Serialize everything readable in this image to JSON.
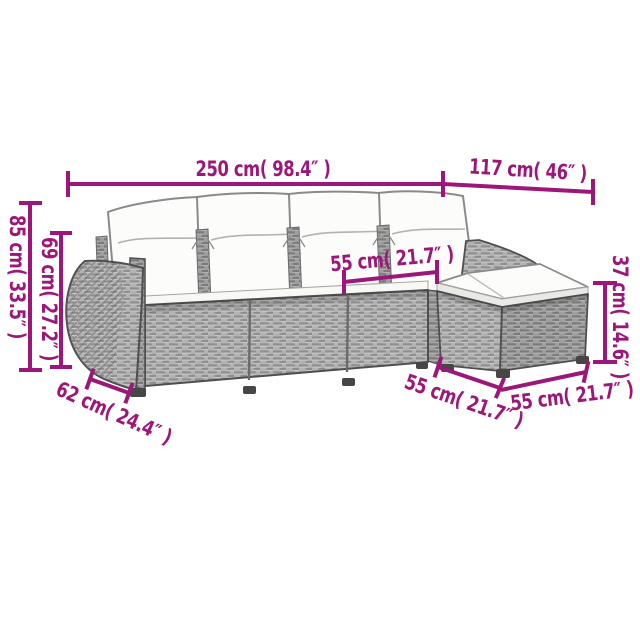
{
  "colors": {
    "accent": "#9c1779",
    "rattan": "#b3b3b3",
    "rattan_dark": "#9f9f9f",
    "weave_line": "#8f8f8f",
    "cushion": "#fcfcfa",
    "outline": "#4f4f4f",
    "background": "#ffffff"
  },
  "dimensions": {
    "total_width": "250 cm( 98.4″ )",
    "total_depth": "117 cm( 46″ )",
    "back_height": "85 cm( 33.5″ )",
    "arm_height": "69 cm( 27.2″ )",
    "seat_width": "55 cm( 21.7″ )",
    "ottoman_height": "37 cm( 14.6″ )",
    "arm_depth": "62 cm( 24.4″ )",
    "seat_depth": "55 cm( 21.7″ )",
    "ottoman_width": "55 cm( 21.7″ )"
  }
}
